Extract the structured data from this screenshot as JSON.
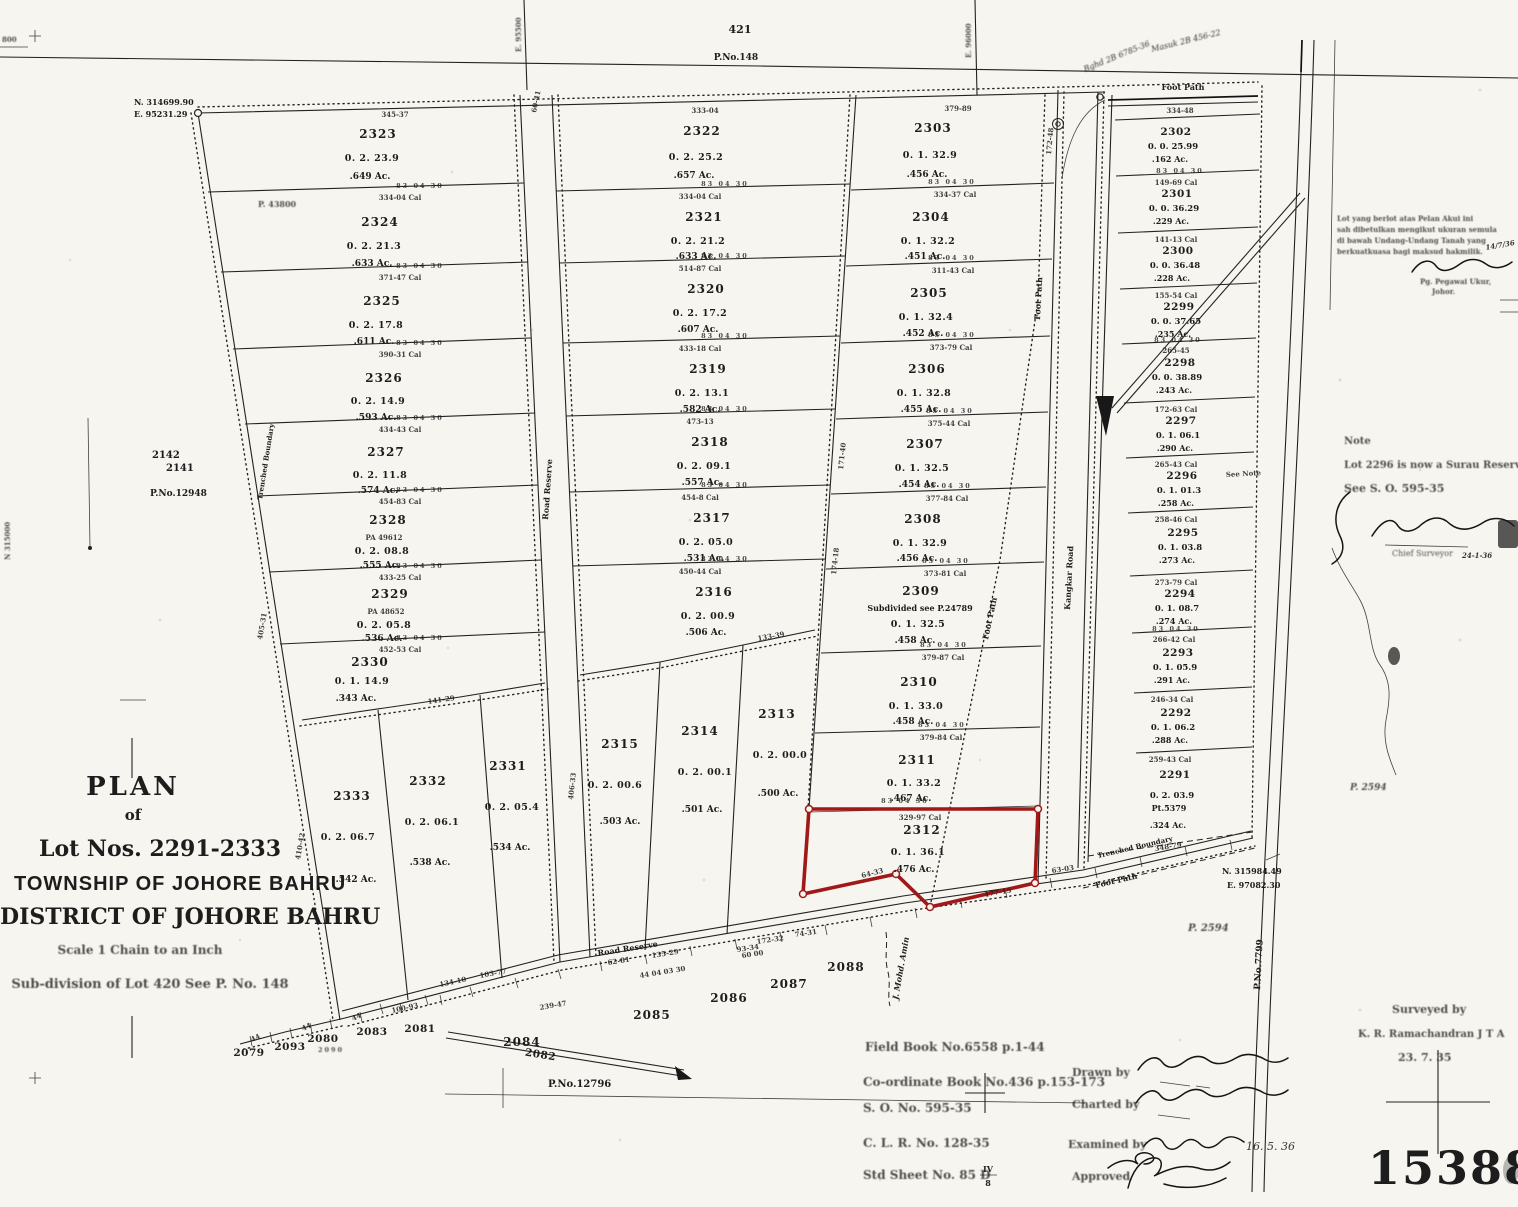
{
  "colors": {
    "paper": "#f7f5ef",
    "ink": "#1d1d1d",
    "highlight": "#a01818"
  },
  "stamp": {
    "number": "15388"
  },
  "top_strip": {
    "lot": "421",
    "plan": "P.No.148",
    "grid_e_left": "E. 95500",
    "grid_e_right": "E. 96000",
    "foot_path": "Foot Path",
    "note1": "Bghd 2B 6785-36",
    "note2": "Masuk 2B 456-22"
  },
  "corners": {
    "nw_n": "N. 314699.90",
    "nw_e": "E. 95231.29",
    "se_n": "N. 315984.49",
    "se_e": "E. 97082.30",
    "n_grid": "N 315000",
    "edge_top": "800"
  },
  "title_block": {
    "plan": "PLAN",
    "of": "of",
    "lots": "Lot Nos. 2291-2333",
    "township": "TOWNSHIP OF JOHORE BAHRU",
    "district": "DISTRICT OF JOHORE BAHRU",
    "scale": "Scale 1 Chain to an Inch",
    "subdivision": "Sub-division of Lot 420 See P. No. 148"
  },
  "note_block": {
    "title": "Note",
    "line1": "Lot 2296 is now a Surau Reserve.",
    "line2": "See S. O. 595-35",
    "signoff": "Chief Surveyor",
    "date": "24-1-36"
  },
  "malay_note": {
    "l1": "Lot yang berlot atas Pelan Akui ini",
    "l2": "sah dibetulkan mengikut ukuran semula",
    "l3": "di bawah Undang-Undang Tanah yang",
    "l4": "berkuatkuasa bagi maksud hakmilik.",
    "sig_title": "Pg. Pegawai Ukur,",
    "sig_place": "Johor.",
    "date": "14/7/36"
  },
  "refs": {
    "field_book": "Field Book No.6558 p.1-44",
    "coord_book": "Co-ordinate Book No.436 p.153-173",
    "so": "S. O. No. 595-35",
    "clr": "C. L. R. No. 128-35",
    "std_sheet": "Std Sheet No. 85 D",
    "frac_num": "IV",
    "frac_den": "8"
  },
  "approvals": {
    "drawn": "Drawn by",
    "charted": "Charted by",
    "examined": "Examined by",
    "examined_date": "16. 5. 36",
    "approved": "Approved"
  },
  "credit": {
    "label": "Surveyed by",
    "name": "K. R. Ramachandran  J T A",
    "date": "23. 7. 35"
  },
  "labels": {
    "road_reserve_v": "Road Reserve",
    "road_reserve_b": "Road Reserve",
    "foot_path_diag": "Foot Path",
    "foot_path_road": "Foot Path",
    "foot_path_top": "Foot Path",
    "foot_path_se": "Foot Path",
    "kangkar": "Kangkar Road",
    "trenched_w": "Trenched Boundary",
    "trenched_se": "Trenched Boundary",
    "stream": "J. Mohd. Amin",
    "p7799": "P.No.7799",
    "p2594_a": "P. 2594",
    "p2594_b": "P. 2594",
    "p12796": "P.No.12796",
    "p12948": "P.No.12948",
    "p43800": "P. 43800",
    "lot2142": "2142",
    "lot2141": "2141",
    "see_note": "See Note"
  },
  "lots": {
    "left": [
      {
        "num": "2323",
        "rp": "0. 2. 23.9",
        "ac": ".649 Ac."
      },
      {
        "num": "2324",
        "rp": "0. 2. 21.3",
        "ac": ".633 Ac."
      },
      {
        "num": "2325",
        "rp": "0. 2. 17.8",
        "ac": ".611 Ac."
      },
      {
        "num": "2326",
        "rp": "0. 2. 14.9",
        "ac": ".593 Ac."
      },
      {
        "num": "2327",
        "rp": "0. 2. 11.8",
        "ac": ".574 Ac."
      },
      {
        "num": "2328",
        "pa": "PA 49612",
        "rp": "0. 2. 08.8",
        "ac": ".555 Ac."
      },
      {
        "num": "2329",
        "pa": "PA 48652",
        "rp": "0. 2. 05.8",
        "ac": ".536 Ac."
      },
      {
        "num": "2330",
        "rp": "0. 1. 14.9",
        "ac": ".343 Ac."
      }
    ],
    "left_bottom": [
      {
        "num": "2333",
        "rp": "0. 2. 06.7",
        "ac": ".542 Ac."
      },
      {
        "num": "2332",
        "rp": "0. 2. 06.1",
        "ac": ".538 Ac."
      },
      {
        "num": "2331",
        "rp": "0. 2. 05.4",
        "ac": ".534 Ac."
      }
    ],
    "middle": [
      {
        "num": "2322",
        "rp": "0. 2. 25.2",
        "ac": ".657 Ac."
      },
      {
        "num": "2321",
        "rp": "0. 2. 21.2",
        "ac": ".633 Ac."
      },
      {
        "num": "2320",
        "rp": "0. 2. 17.2",
        "ac": ".607 Ac."
      },
      {
        "num": "2319",
        "rp": "0. 2. 13.1",
        "ac": ".582 Ac."
      },
      {
        "num": "2318",
        "rp": "0. 2. 09.1",
        "ac": ".557 Ac."
      },
      {
        "num": "2317",
        "rp": "0. 2. 05.0",
        "ac": ".531 Ac."
      },
      {
        "num": "2316",
        "rp": "0. 2. 00.9",
        "ac": ".506 Ac."
      }
    ],
    "middle_bottom": [
      {
        "num": "2315",
        "rp": "0. 2. 00.6",
        "ac": ".503 Ac."
      },
      {
        "num": "2314",
        "rp": "0. 2. 00.1",
        "ac": ".501 Ac."
      },
      {
        "num": "2313",
        "rp": "0. 2. 00.0",
        "ac": ".500 Ac."
      }
    ],
    "mid_right": [
      {
        "num": "2303",
        "rp": "0. 1. 32.9",
        "ac": ".456 Ac."
      },
      {
        "num": "2304",
        "rp": "0. 1. 32.2",
        "ac": ".451 Ac."
      },
      {
        "num": "2305",
        "rp": "0. 1. 32.4",
        "ac": ".452 Ac."
      },
      {
        "num": "2306",
        "rp": "0. 1. 32.8",
        "ac": ".455 Ac."
      },
      {
        "num": "2307",
        "rp": "0. 1. 32.5",
        "ac": ".454 Ac."
      },
      {
        "num": "2308",
        "rp": "0. 1. 32.9",
        "ac": ".456 Ac."
      },
      {
        "num": "2309",
        "extra": "Subdivided see P.24789",
        "rp": "0. 1. 32.5",
        "ac": ".458 Ac."
      },
      {
        "num": "2310",
        "rp": "0. 1. 33.0",
        "ac": ".458 Ac."
      },
      {
        "num": "2311",
        "rp": "0. 1. 33.2",
        "ac": ".467 Ac."
      }
    ],
    "red_lot": {
      "num": "2312",
      "rp": "0. 1. 36.1",
      "ac": ".476 Ac."
    },
    "right": [
      {
        "num": "2302",
        "rp": "0. 0. 25.99",
        "ac": ".162 Ac."
      },
      {
        "num": "2301",
        "rp": "0. 0. 36.29",
        "ac": ".229 Ac."
      },
      {
        "num": "2300",
        "rp": "0. 0. 36.48",
        "ac": ".228 Ac."
      },
      {
        "num": "2299",
        "rp": "0. 0. 37.65",
        "ac": ".235 Ac."
      },
      {
        "num": "2298",
        "rp": "0. 0. 38.89",
        "ac": ".243 Ac."
      },
      {
        "num": "2297",
        "rp": "0. 1. 06.1",
        "ac": ".290 Ac."
      },
      {
        "num": "2296",
        "rp": "0. 1. 01.3",
        "ac": ".258 Ac."
      },
      {
        "num": "2295",
        "rp": "0. 1. 03.8",
        "ac": ".273 Ac."
      },
      {
        "num": "2294",
        "rp": "0. 1. 08.7",
        "ac": ".274 Ac."
      },
      {
        "num": "2293",
        "rp": "0. 1. 05.9",
        "ac": ".291 Ac."
      },
      {
        "num": "2292",
        "rp": "0. 1. 06.2",
        "ac": ".288 Ac."
      },
      {
        "num": "2291",
        "rp": "0. 2. 03.9",
        "pt": "Pt.5379",
        "ac": ".324 Ac."
      }
    ],
    "south": {
      "l2084": "2084",
      "l2085": "2085",
      "l2086": "2086",
      "l2087": "2087",
      "l2088": "2088",
      "l2079": "2079",
      "l2093": "2093",
      "l2080": "2080",
      "l2090": "2090",
      "l2083": "2083",
      "l2081": "2081",
      "l2082": "2082"
    }
  },
  "decor": {
    "ticks": "83 04 30",
    "top_dim_left": "345-37",
    "top_dim_mid": "333-04",
    "top_dim_midright": "379-89",
    "top_dim_right": "334-48",
    "cal_left": [
      "334-04 Cal",
      "371-47 Cal",
      "390-31 Cal",
      "434-43 Cal",
      "454-83 Cal",
      "433-25 Cal",
      "452-53 Cal"
    ],
    "cal_mid": [
      "334-04 Cal",
      "514-87 Cal",
      "433-18 Cal",
      "473-13",
      "454-8 Cal",
      "450-44 Cal"
    ],
    "cal_midright": [
      "334-37 Cal",
      "311-43 Cal",
      "373-79 Cal",
      "375-44 Cal",
      "377-84 Cal",
      "373-81 Cal",
      "379-87 Cal",
      "379-84 Cal",
      "329-97 Cal"
    ],
    "cal_right": [
      "149-69 Cal",
      "141-13 Cal",
      "155-54 Cal",
      "265-45",
      "172-63 Cal",
      "265-43 Cal",
      "258-46 Cal",
      "273-79 Cal",
      "266-42 Cal",
      "246-34 Cal",
      "259-43 Cal"
    ],
    "misc": [
      "60-41",
      "64-33",
      "177-15",
      "63-03",
      "134-10",
      "239-47",
      "100-93",
      "135-29",
      "103-77",
      "172-32",
      "74-31",
      "60 00",
      "405-31",
      "410-42",
      "172-48",
      "171-40",
      "174-18",
      "406-33",
      "141-29",
      "133-39",
      "348-79",
      "44",
      "44",
      "44",
      "62-81",
      "93-34",
      "44 04 03 30"
    ]
  }
}
